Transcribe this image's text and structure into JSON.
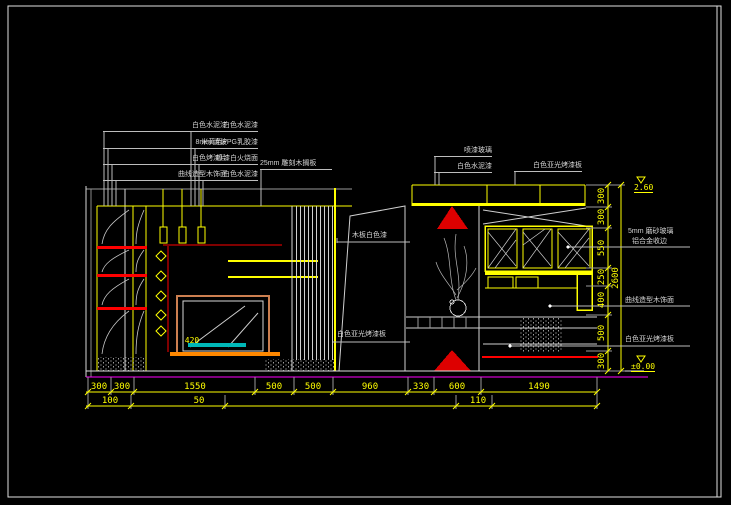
{
  "drawing_labels": {
    "col1": [
      "白色水泥漆",
      "8mm 清玻",
      "白色烤漆片",
      "曲线造型木饰面"
    ],
    "col2": [
      "白色水泥漆",
      "米黄色PPG乳胶漆",
      "喷漆白火烧面",
      "白色水泥漆"
    ],
    "shelf_note": "25mm 雕刻木搁板",
    "col4": [
      "喷漆玻璃",
      "白色水泥漆"
    ],
    "col5": "白色亚光烤漆板",
    "panel_note": "木板白色漆",
    "panel_note2": "白色亚光烤漆板",
    "right_note1a": "5mm 磨砂玻璃",
    "right_note1b": "铝合金收边",
    "right_note2": "曲线造型木饰面",
    "right_note3": "白色亚光烤漆板",
    "inner_dim": "420"
  },
  "dimensions": {
    "bottom_row1": [
      "300",
      "300",
      "1550",
      "500",
      "500",
      "960",
      "330",
      "600",
      "1490"
    ],
    "bottom_row2": [
      "100",
      "50",
      "110"
    ],
    "right_chain": [
      "300",
      "300",
      "550",
      "250",
      "400",
      "500",
      "300"
    ],
    "right_total": "2600",
    "level_top": "2.60",
    "level_bottom": "±0.00"
  },
  "colors": {
    "background": "#000000",
    "line_yellow": "#ffff00",
    "line_white": "#d9d9d9",
    "accent_red": "#ff0000",
    "accent_cyan": "#00b8b8",
    "accent_orange": "#ff8800",
    "fireplace_frame": "#cc7f50",
    "floor_magenta": "#ff00ff"
  }
}
